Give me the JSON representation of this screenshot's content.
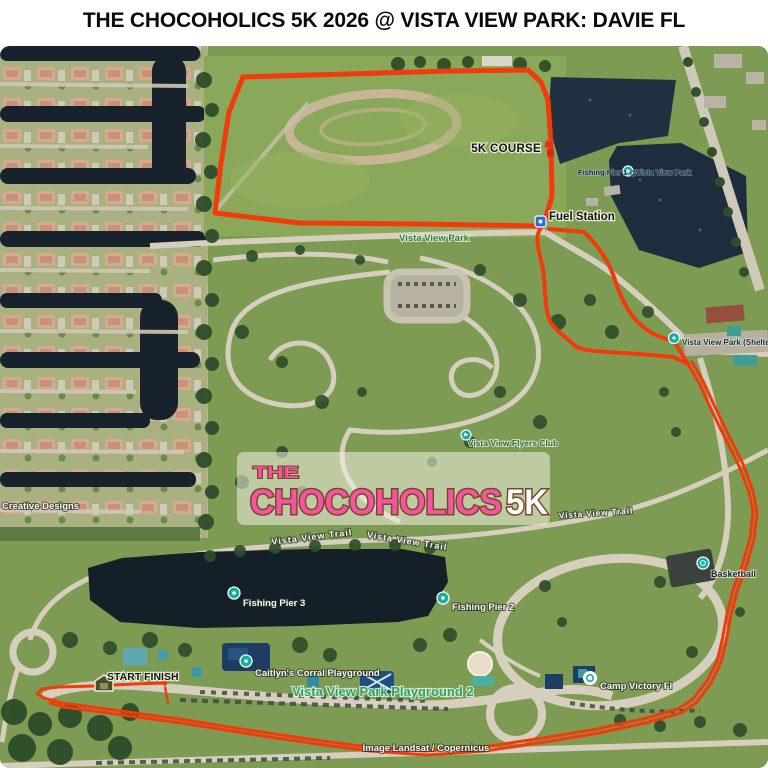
{
  "header": {
    "title": "THE CHOCOHOLICS 5K 2026 @ VISTA VIEW PARK: DAVIE FL"
  },
  "logo": {
    "the": "THE",
    "chocoholics": "CHOCOHOLICS",
    "fivek": "5K"
  },
  "annotations": {
    "course": "5K COURSE",
    "fuel": "Fuel Station",
    "start_finish": "START FINISH"
  },
  "pois": {
    "pier1_prefix": "Fishing Pier 1 @",
    "pier1_suffix": "Vista View Park",
    "park": "Vista View Park",
    "shelter": "Vista View Park (Shelter 3",
    "flyers": "Vista View Flyers Club",
    "trail": "Vista View Trail",
    "basketball": "Basketball",
    "pier3": "Fishing Pier 3",
    "pier2": "Fishing Pier 2",
    "caitlyn": "Caitlyn's Corral Playground",
    "playground2": "Vista View Park Playground 2",
    "camp": "Camp Victory Fl",
    "creative": "Creative Designs"
  },
  "attribution": "Image Landsat / Copernicus",
  "colors": {
    "course_red": "#f23a0c",
    "logo_pink": "#f355a2",
    "logo_brown": "#7a4526",
    "poi_teal": "#11b0a2",
    "water_dark": "#17222c",
    "field_green": "#8aa859"
  }
}
